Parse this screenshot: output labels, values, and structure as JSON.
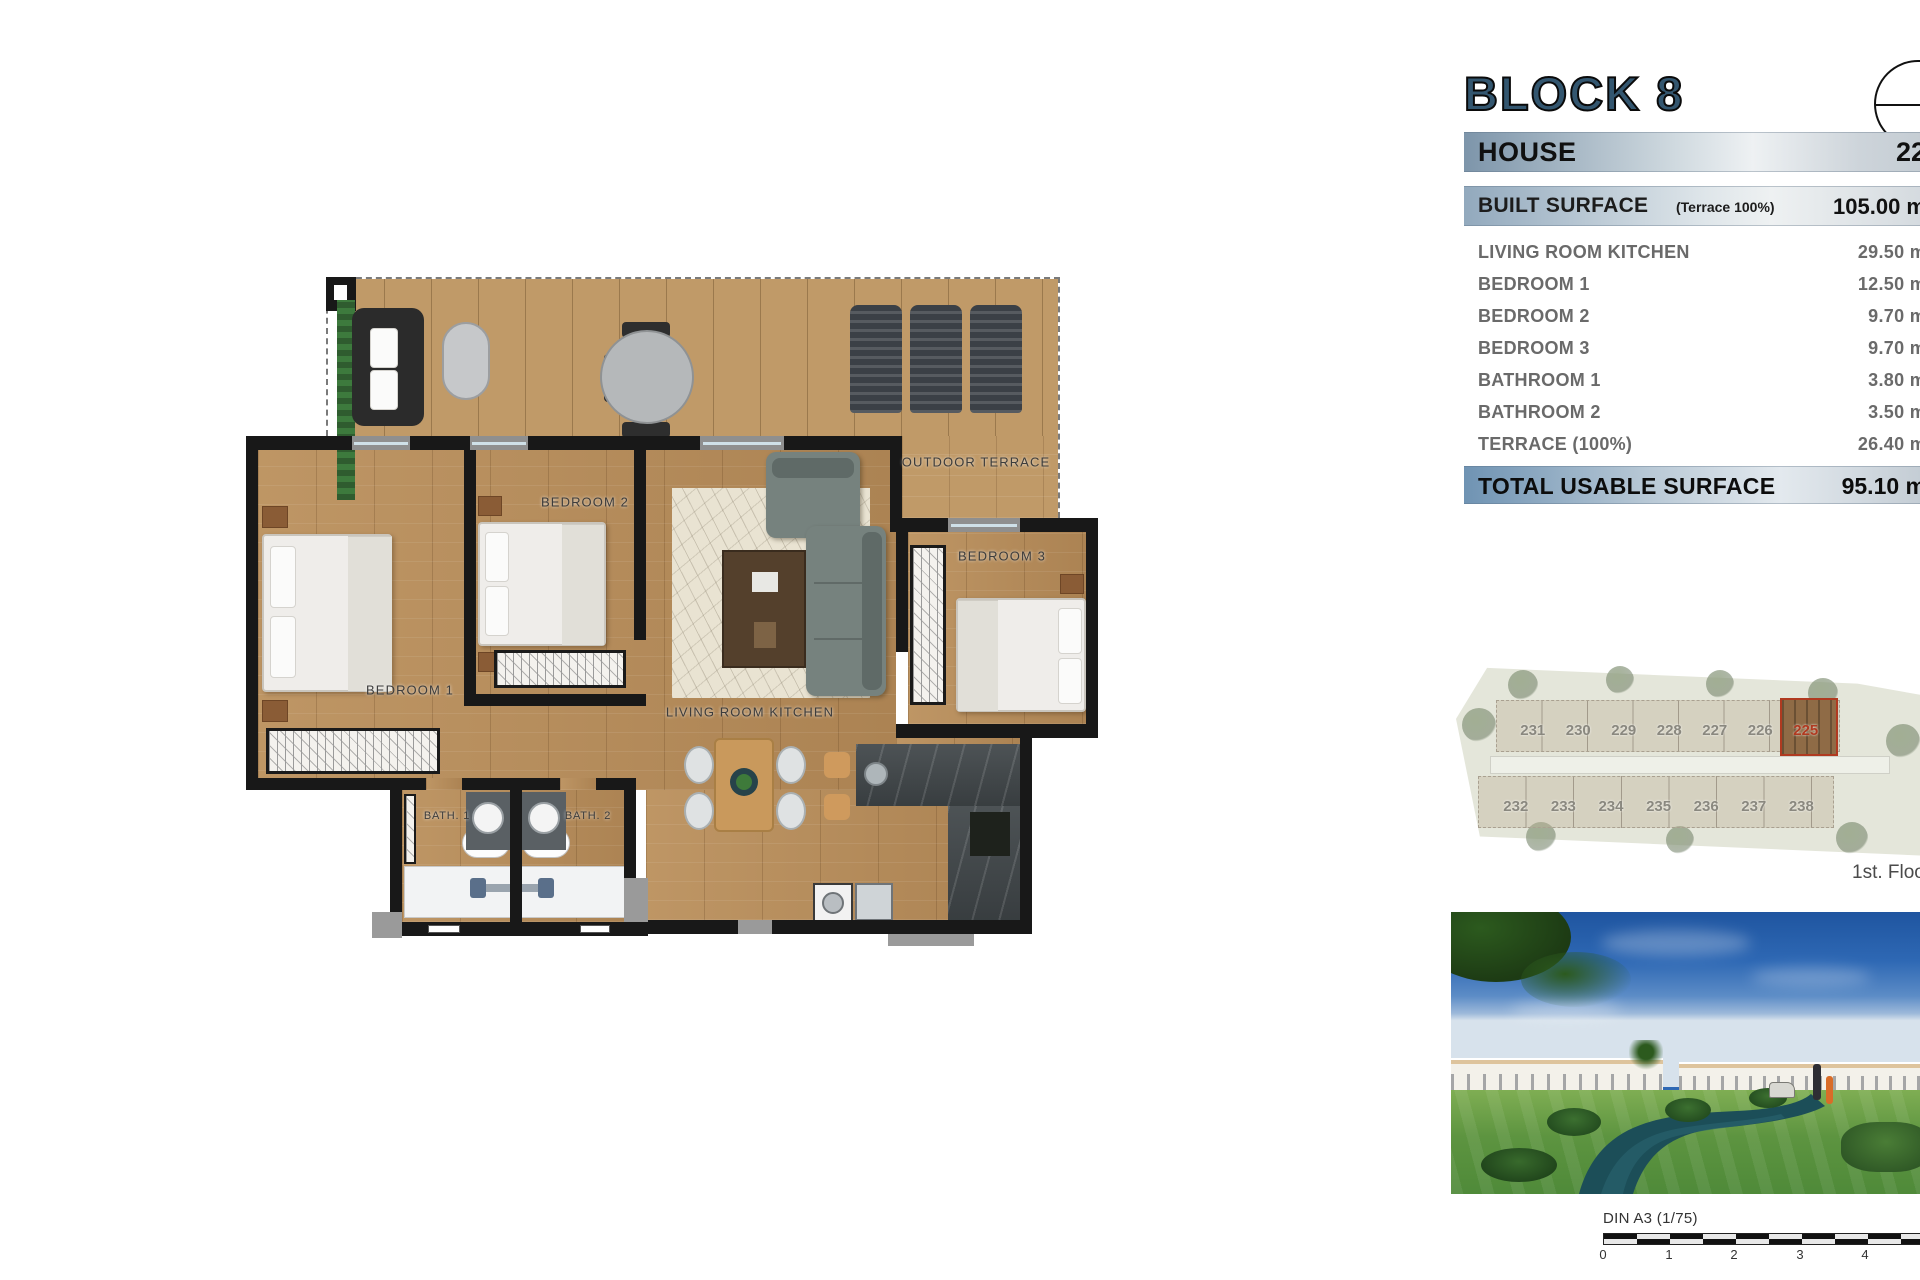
{
  "header": {
    "block_title": "BLOCK 8"
  },
  "table": {
    "house_label": "HOUSE",
    "house_value": "22",
    "built_label": "BUILT SURFACE",
    "built_note": "(Terrace 100%)",
    "built_value": "105.00 m",
    "rows": [
      {
        "label": "LIVING ROOM KITCHEN",
        "value": "29.50 m"
      },
      {
        "label": "BEDROOM 1",
        "value": "12.50 m"
      },
      {
        "label": "BEDROOM 2",
        "value": "9.70 m"
      },
      {
        "label": "BEDROOM 3",
        "value": "9.70 m"
      },
      {
        "label": "BATHROOM 1",
        "value": "3.80 m"
      },
      {
        "label": "BATHROOM 2",
        "value": "3.50 m"
      },
      {
        "label": "TERRACE (100%)",
        "value": "26.40 m"
      }
    ],
    "total_label": "TOTAL USABLE SURFACE",
    "total_value": "95.10 m"
  },
  "floorplan": {
    "terrace_label": "OUTDOOR TERRACE",
    "bedroom1_label": "BEDROOM 1",
    "bedroom2_label": "BEDROOM 2",
    "bedroom3_label": "BEDROOM 3",
    "living_label": "LIVING ROOM KITCHEN",
    "bath1_label": "BATH. 1",
    "bath2_label": "BATH. 2"
  },
  "siteplan": {
    "top_units": [
      "231",
      "230",
      "229",
      "228",
      "227",
      "226",
      "225"
    ],
    "bottom_units": [
      "232",
      "233",
      "234",
      "235",
      "236",
      "237",
      "238"
    ],
    "highlighted_unit": "225",
    "floor_label": "1st. Floor"
  },
  "scalebar": {
    "label": "DIN A3 (1/75)",
    "ticks": [
      "0",
      "1",
      "2",
      "3",
      "4"
    ]
  },
  "colors": {
    "accent_blue": "#33566f",
    "highlight_red": "#b03a20",
    "band_blue": "#7d95aa"
  }
}
